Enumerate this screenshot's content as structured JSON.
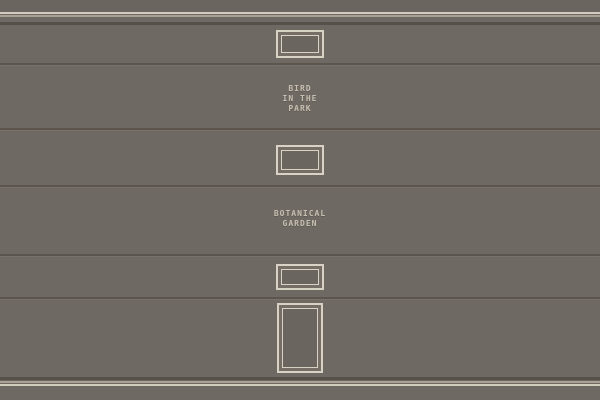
{
  "labels": {
    "bird_in_the_park": "BIRD\nIN THE\nPARK",
    "botanical_garden": "BOTANICAL\nGARDEN"
  },
  "colors": {
    "wall": "#6F6963",
    "wall_top_band": "#6B655F",
    "stripe_bright": "#D2CCBF",
    "stripe_muted": "#A9A194",
    "stripe_dark": "#56504A",
    "seam_dark": "#5B554E",
    "seam_light": "#78726B",
    "frame_light": "#D8D2C5",
    "frame_body": "#746E67",
    "frame_interior": "#6B655F",
    "label_text": "#C7C0B2"
  }
}
